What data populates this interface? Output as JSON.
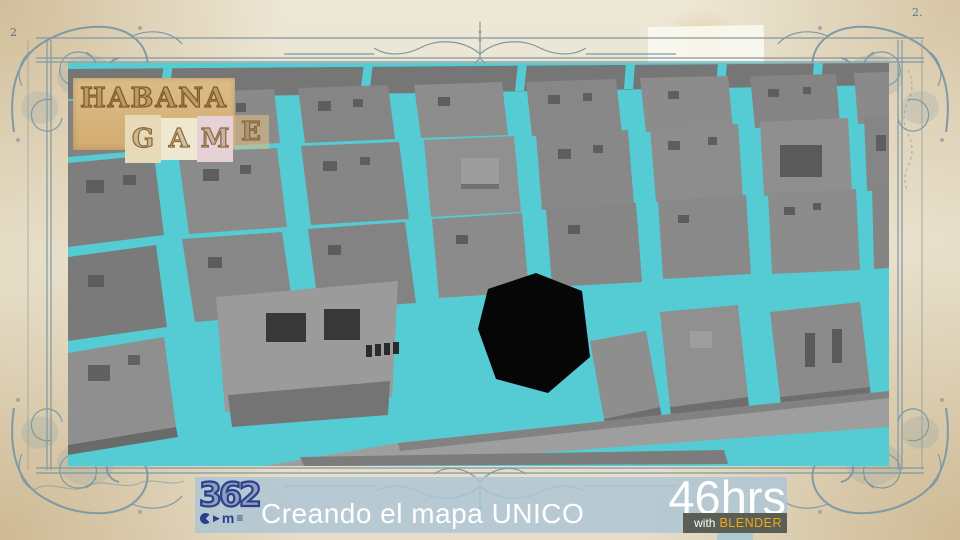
{
  "colors": {
    "ink": "#7f99a5",
    "cyan": "#55ccd4",
    "navy": "#2b3f8c",
    "banner_bg": "rgba(174,197,211,0.85)",
    "box_bg": "#5a5e55",
    "orange": "#f2a818",
    "logo_stroke": "#7c5c2c"
  },
  "frame": {
    "mark_tl": "2",
    "mark_tr": "2."
  },
  "logo": {
    "title": "HABANA",
    "letters": [
      "G",
      "A",
      "M",
      "E"
    ]
  },
  "banner": {
    "brand_digits": "362",
    "icons": {
      "play": "▶",
      "lines": "≡"
    },
    "brand_sub": "m",
    "title": "Creando el mapa UNICO",
    "hours": "46hrs",
    "with_label": "with",
    "tool_label": "BLENDER"
  },
  "map": {
    "bg": "#55ccd4",
    "polygons": [
      {
        "p": "0,6 821,0 821,22 0,36",
        "f": "#767676"
      },
      {
        "p": "96,0 105,0 100,38 91,38",
        "f": "#55ccd4"
      },
      {
        "p": "296,0 305,0 301,32 292,32",
        "f": "#55ccd4"
      },
      {
        "p": "450,0 459,0 456,28 447,28",
        "f": "#55ccd4"
      },
      {
        "p": "558,0 567,0 565,26 556,26",
        "f": "#55ccd4"
      },
      {
        "p": "650,0 659,0 657,24 648,24",
        "f": "#55ccd4"
      },
      {
        "p": "746,0 755,0 753,22 744,22",
        "f": "#55ccd4"
      },
      {
        "p": "0,38 88,31 93,86 0,94",
        "f": "#828282"
      },
      {
        "p": "112,30 206,26 212,80 119,85",
        "f": "#8a8a8a"
      },
      {
        "p": "230,25 320,22 327,76 237,80",
        "f": "#858585"
      },
      {
        "p": "346,22 434,19 440,72 353,75",
        "f": "#8d8d8d"
      },
      {
        "p": "458,19 548,16 554,70 464,73",
        "f": "#878787"
      },
      {
        "p": "572,15 660,13 665,66 578,69",
        "f": "#8c8c8c"
      },
      {
        "p": "682,13 768,11 772,62 687,65",
        "f": "#848484"
      },
      {
        "p": "786,10 821,9 821,60 790,61",
        "f": "#8a8a8a"
      },
      {
        "p": "0,100 86,92 96,172 0,184",
        "f": "#7e7e7e"
      },
      {
        "p": "110,90 209,85 219,164 121,171",
        "f": "#8b8b8b"
      },
      {
        "p": "233,83 331,79 341,156 243,162",
        "f": "#868686"
      },
      {
        "p": "356,77 446,73 453,149 363,154",
        "f": "#909090"
      },
      {
        "p": "468,71 560,67 566,142 474,147",
        "f": "#888888"
      },
      {
        "p": "582,65 670,61 675,135 588,139",
        "f": "#8d8d8d"
      },
      {
        "p": "692,59 780,55 784,129 696,133",
        "f": "#8f8f8f"
      },
      {
        "p": "796,53 821,52 821,127 799,128",
        "f": "#858585"
      },
      {
        "p": "0,194 88,182 99,264 0,278",
        "f": "#7a7a7a"
      },
      {
        "p": "114,176 214,169 226,251 127,259",
        "f": "#878787"
      },
      {
        "p": "240,166 337,159 348,240 251,247",
        "f": "#838383"
      },
      {
        "p": "364,156 454,150 461,229 371,235",
        "f": "#8b8b8b"
      },
      {
        "p": "478,146 568,140 574,219 484,224",
        "f": "#868686"
      },
      {
        "p": "590,138 678,132 683,211 595,216",
        "f": "#898989"
      },
      {
        "p": "700,130 788,126 792,207 704,211",
        "f": "#8c8c8c"
      },
      {
        "p": "804,124 821,123 821,205 806,206",
        "f": "#848484"
      },
      {
        "p": "0,290 96,274 108,364 0,382",
        "f": "#8f8f8f"
      },
      {
        "p": "0,382 108,364 110,374 0,392",
        "f": "#6a6a6a"
      },
      {
        "p": "148,234 330,218 324,334 157,349",
        "f": "#9b9b9b"
      },
      {
        "p": "160,332 322,318 320,352 164,364",
        "f": "#747474"
      },
      {
        "p": "420,226 468,210 514,228 522,294 480,330 428,316 410,266",
        "f": "#060606"
      },
      {
        "p": "522,278 578,268 592,344 536,356",
        "f": "#8e8e8e"
      },
      {
        "p": "536,356 592,344 594,354 538,366",
        "f": "#6e6e6e"
      },
      {
        "p": "592,249 670,242 680,334 602,344",
        "f": "#909090"
      },
      {
        "p": "602,344 680,334 681,344 603,354",
        "f": "#6e6e6e"
      },
      {
        "p": "702,249 792,239 802,324 712,334",
        "f": "#8b8b8b"
      },
      {
        "p": "712,334 802,324 803,334 713,344",
        "f": "#6e6e6e"
      },
      {
        "p": "196,403 330,380 821,328 821,364 292,403",
        "f": "#9e9e9e"
      },
      {
        "p": "330,380 821,328 821,335 332,388",
        "f": "#828282"
      },
      {
        "p": "232,394 656,387 660,401 236,403",
        "f": "#7c7c7c"
      }
    ],
    "holes": [
      [
        20,
        48,
        16,
        12,
        "#5e5e5e"
      ],
      [
        52,
        44,
        12,
        10,
        "#5e5e5e"
      ],
      [
        130,
        42,
        14,
        11,
        "#5e5e5e"
      ],
      [
        168,
        40,
        10,
        9,
        "#5e5e5e"
      ],
      [
        250,
        38,
        13,
        10,
        "#5e5e5e"
      ],
      [
        285,
        36,
        10,
        8,
        "#5e5e5e"
      ],
      [
        370,
        34,
        12,
        9,
        "#5e5e5e"
      ],
      [
        480,
        32,
        12,
        9,
        "#5e5e5e"
      ],
      [
        515,
        30,
        9,
        8,
        "#5e5e5e"
      ],
      [
        600,
        28,
        11,
        8,
        "#5e5e5e"
      ],
      [
        700,
        26,
        11,
        8,
        "#5e5e5e"
      ],
      [
        735,
        24,
        8,
        7,
        "#5e5e5e"
      ],
      [
        18,
        117,
        18,
        13,
        "#5e5e5e"
      ],
      [
        55,
        112,
        13,
        10,
        "#5e5e5e"
      ],
      [
        135,
        106,
        16,
        12,
        "#5e5e5e"
      ],
      [
        172,
        102,
        11,
        9,
        "#5e5e5e"
      ],
      [
        255,
        98,
        14,
        10,
        "#5e5e5e"
      ],
      [
        292,
        94,
        10,
        8,
        "#5e5e5e"
      ],
      [
        490,
        86,
        13,
        10,
        "#5e5e5e"
      ],
      [
        525,
        82,
        10,
        8,
        "#5e5e5e"
      ],
      [
        600,
        78,
        12,
        9,
        "#5e5e5e"
      ],
      [
        640,
        74,
        9,
        8,
        "#5e5e5e"
      ],
      [
        808,
        72,
        10,
        16,
        "#5e5e5e"
      ],
      [
        712,
        82,
        42,
        32,
        "#5a5a5a"
      ],
      [
        393,
        95,
        38,
        28,
        "#9c9c9c"
      ],
      [
        393,
        121,
        38,
        5,
        "#707070"
      ],
      [
        20,
        212,
        16,
        12,
        "#5c5c5c"
      ],
      [
        140,
        194,
        14,
        11,
        "#5c5c5c"
      ],
      [
        260,
        182,
        13,
        10,
        "#5c5c5c"
      ],
      [
        388,
        172,
        12,
        9,
        "#5c5c5c"
      ],
      [
        500,
        162,
        12,
        9,
        "#5c5c5c"
      ],
      [
        610,
        152,
        11,
        8,
        "#5c5c5c"
      ],
      [
        716,
        144,
        11,
        8,
        "#5c5c5c"
      ],
      [
        745,
        140,
        8,
        7,
        "#5c5c5c"
      ],
      [
        20,
        302,
        22,
        16,
        "#616161"
      ],
      [
        60,
        292,
        12,
        10,
        "#616161"
      ],
      [
        622,
        268,
        22,
        17,
        "#9e9e9e"
      ],
      [
        737,
        270,
        10,
        34,
        "#5a5a5a"
      ],
      [
        764,
        266,
        10,
        34,
        "#5a5a5a"
      ],
      [
        198,
        250,
        40,
        29,
        "#383838"
      ],
      [
        256,
        246,
        36,
        31,
        "#383838"
      ],
      [
        298,
        282,
        6,
        12,
        "#2a2a2a"
      ],
      [
        307,
        281,
        6,
        12,
        "#2a2a2a"
      ],
      [
        316,
        280,
        6,
        12,
        "#2a2a2a"
      ],
      [
        325,
        279,
        6,
        12,
        "#2a2a2a"
      ]
    ]
  }
}
